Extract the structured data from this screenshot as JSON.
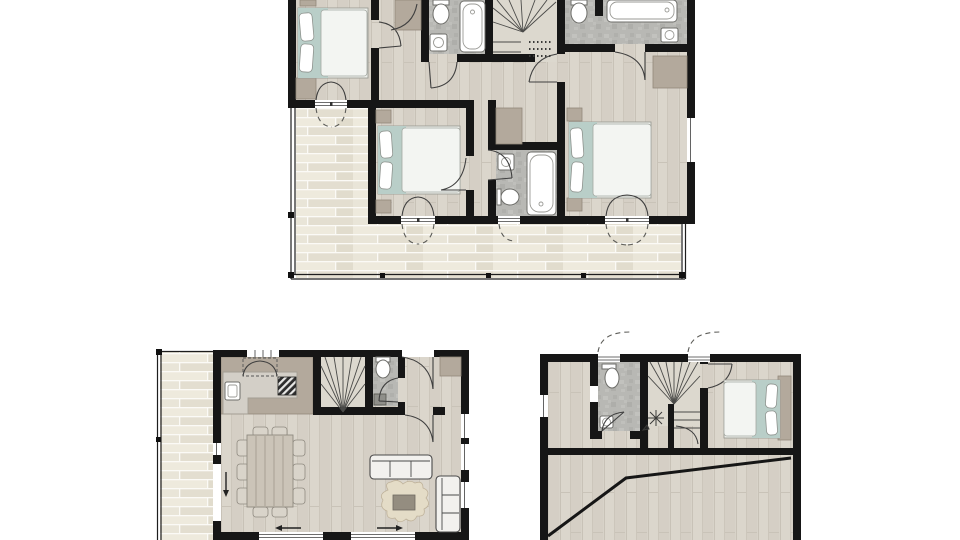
{
  "canvas": {
    "width": 960,
    "height": 540,
    "background": "#ffffff"
  },
  "palette": {
    "wall": "#161616",
    "woodFloor": "#d8d3c9",
    "bathFloor": "#b8b8b4",
    "deckPlank": "#e9e5d8",
    "cabinet": "#b3a99c",
    "counter": "#d3cfc7",
    "blanket": "#b9cec8",
    "duvet": "#f3f5f2",
    "pillow": "#ffffff",
    "sofa": "#f2f1ee",
    "sofaStroke": "#4a4a4a",
    "rug": "#e4dcc7",
    "table": "#cbc4b8",
    "chair": "#d9d4ca",
    "doorArc": "#3f3f3f"
  },
  "plans": [
    {
      "id": "upper-floor-plan",
      "rooms": [
        "bedroom-left",
        "bedroom-middle",
        "bedroom-right",
        "bathroom-top-left",
        "bathroom-top-right",
        "bathroom-middle",
        "hallway",
        "winder-staircase",
        "wrap-around-balcony"
      ],
      "fixtures": [
        "double-bed",
        "double-bed",
        "double-bed",
        "bathtub",
        "bathtub",
        "bathtub",
        "toilet",
        "toilet",
        "toilet",
        "washbasin",
        "washbasin",
        "washbasin",
        "wardrobe",
        "closet",
        "nightstands",
        "french-doors",
        "balcony-railing"
      ]
    },
    {
      "id": "ground-floor-plan",
      "rooms": [
        "kitchen",
        "living-dining-room",
        "wc",
        "entry",
        "winder-staircase",
        "side-deck"
      ],
      "fixtures": [
        "kitchen-counter",
        "kitchen-sink",
        "stove",
        "upper-cabinets",
        "dining-table",
        "dining-chairs",
        "sofa",
        "chaise-sofa",
        "coffee-table",
        "hide-rug",
        "toilet",
        "washbasin",
        "sliding-doors",
        "entry-door"
      ]
    },
    {
      "id": "loft-floor-plan",
      "rooms": [
        "bathroom",
        "bedroom",
        "winder-staircase",
        "open-attic-space"
      ],
      "fixtures": [
        "double-bed",
        "headboard",
        "toilet",
        "washbasin",
        "roof-window-swings",
        "roof-slope-line",
        "stair-light-symbol"
      ]
    }
  ]
}
